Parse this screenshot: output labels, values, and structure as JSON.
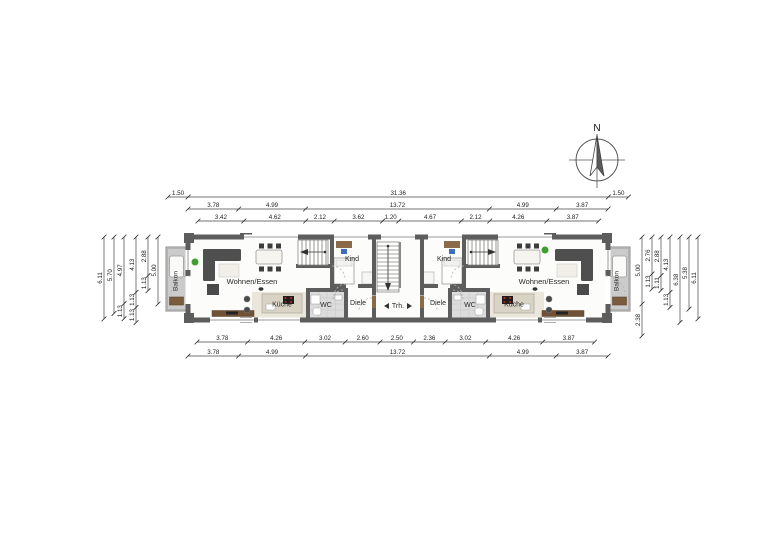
{
  "compass": {
    "north_label": "N"
  },
  "labels": {
    "living": "Wohnen/Essen",
    "kitchen": "Küche",
    "wc": "WC",
    "hall": "Diele",
    "child": "Kind",
    "balcony": "Balkon",
    "stairwell": "Trh."
  },
  "dimensions": {
    "top_rows": [
      {
        "name": "overall-with-balconies",
        "values": [
          "1.50",
          "31.36",
          "1.50"
        ]
      },
      {
        "name": "main-sections",
        "values": [
          "3.78",
          "4.99",
          "13.72",
          "4.99",
          "3.87"
        ]
      },
      {
        "name": "detail-sections",
        "values": [
          "3.42",
          "4.62",
          "2.12",
          "3.62",
          "1.20",
          "4.67",
          "2.12",
          "4.26",
          "3.87"
        ]
      }
    ],
    "bottom_rows": [
      {
        "name": "detail-sections",
        "values": [
          "3.78",
          "4.26",
          "3.02",
          "2.60",
          "2.50",
          "2.36",
          "3.02",
          "4.26",
          "3.87"
        ]
      },
      {
        "name": "main-sections",
        "values": [
          "3.78",
          "4.99",
          "13.72",
          "4.99",
          "3.87"
        ]
      }
    ],
    "left_columns": [
      [
        "6.11"
      ],
      [
        "5.70"
      ],
      [
        "4.97",
        "1.13"
      ],
      [
        "4.13",
        "1.13",
        "1.13"
      ],
      [
        "2.88",
        "1.13"
      ],
      [
        "5.00"
      ]
    ],
    "right_columns": [
      [
        "5.00",
        "2.38"
      ],
      [
        "2.76",
        "1.13"
      ],
      [
        "2.88",
        "1.11"
      ],
      [
        "4.13",
        "1.13"
      ],
      [
        "6.38"
      ],
      [
        "5.38"
      ],
      [
        "6.11"
      ]
    ]
  },
  "colors": {
    "wall": "#5d5d5d",
    "balcony_floor": "#cbcbcb",
    "tile_floor": "#dcdcdc",
    "kitchen_floor": "#ebe6db",
    "wood": "#7a5c3e",
    "sofa": "#4f4f4f",
    "plant": "#3f9e2f",
    "stove_knob": "#d5281c",
    "chair_blue": "#3a6fbf"
  }
}
